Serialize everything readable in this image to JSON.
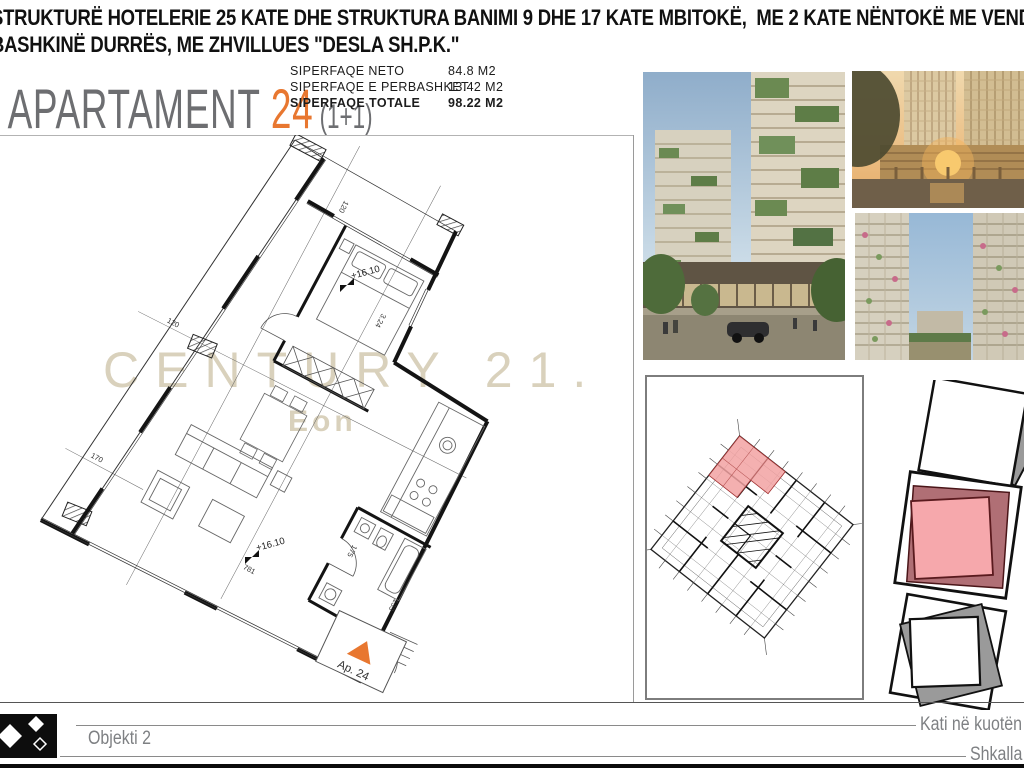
{
  "header": {
    "line1": "STRUKTURË HOTELERIE 25 KATE DHE STRUKTURA BANIMI 9 DHE 17 KATE MBITOKË,  ME 2 KATE NËNTOKË ME VENDNDODHJE NË",
    "line2": "BASHKINË DURRËS, ME ZHVILLUES \"DESLA SH.P.K.\""
  },
  "title": {
    "name": "APARTAMENT",
    "number": "24",
    "type": "(1+1)"
  },
  "areas": {
    "rows": [
      {
        "label": "SIPERFAQE NETO",
        "value": "84.8 M2"
      },
      {
        "label": "SIPERFAQE E PERBASHKET",
        "value": "13.42 M2"
      },
      {
        "label": "SIPERFAQE TOTALE",
        "value": "98.22 M2"
      }
    ]
  },
  "watermark": {
    "line1": "CENTURY 21.",
    "line2": "Eon"
  },
  "plan": {
    "unit_tag": "Ap. 24",
    "level": "+16.10",
    "dims": {
      "balcony": "120",
      "terrace": "120",
      "left": "170",
      "bottom": "781",
      "bed": "3.24",
      "bath": "175",
      "entry": "133"
    }
  },
  "footer": {
    "object": "Objekti 2",
    "floor": "Kati në kuotën +16",
    "scale": "Shkalla 1:"
  },
  "colors": {
    "accent_orange": "#e87730",
    "title_gray": "#6d6e71",
    "watermark_beige": "#d9d1bc",
    "highlight_pink": "#f2a2a2",
    "highlight_maroon": "#b06f75"
  }
}
